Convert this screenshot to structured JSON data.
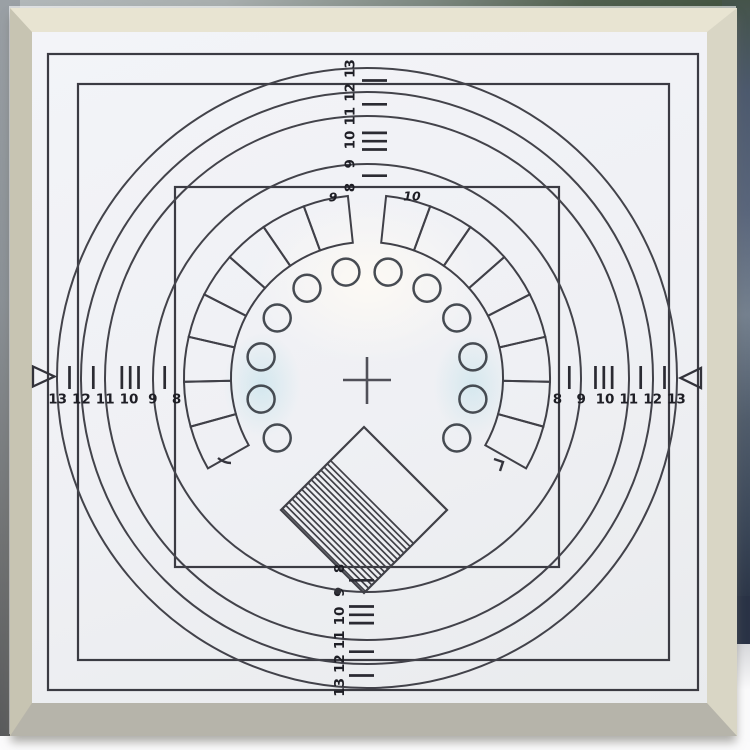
{
  "chart": {
    "scales": {
      "left": {
        "labels": [
          "13",
          "12",
          "11",
          "10",
          "9",
          "8"
        ]
      },
      "right": {
        "labels": [
          "8",
          "9",
          "10",
          "11",
          "12",
          "13"
        ]
      },
      "top": {
        "labels": [
          "13",
          "12",
          "11",
          "10",
          "9",
          "8"
        ]
      },
      "bottom": {
        "labels": [
          "8",
          "9",
          "10",
          "11",
          "12",
          "13"
        ]
      }
    },
    "sector_labels": {
      "left": "9",
      "right": "10"
    }
  },
  "colors": {
    "frame_top": "#e8e4d2",
    "frame_side": "#c7c4b2",
    "frame_bottom": "#b6b4aa",
    "paper": "#f1f1f5",
    "ink": "#393941",
    "background_top": "#51604f",
    "background_right": "#4d5a6e",
    "table": "#fbfbfc",
    "tint": "#bcdfe9"
  }
}
